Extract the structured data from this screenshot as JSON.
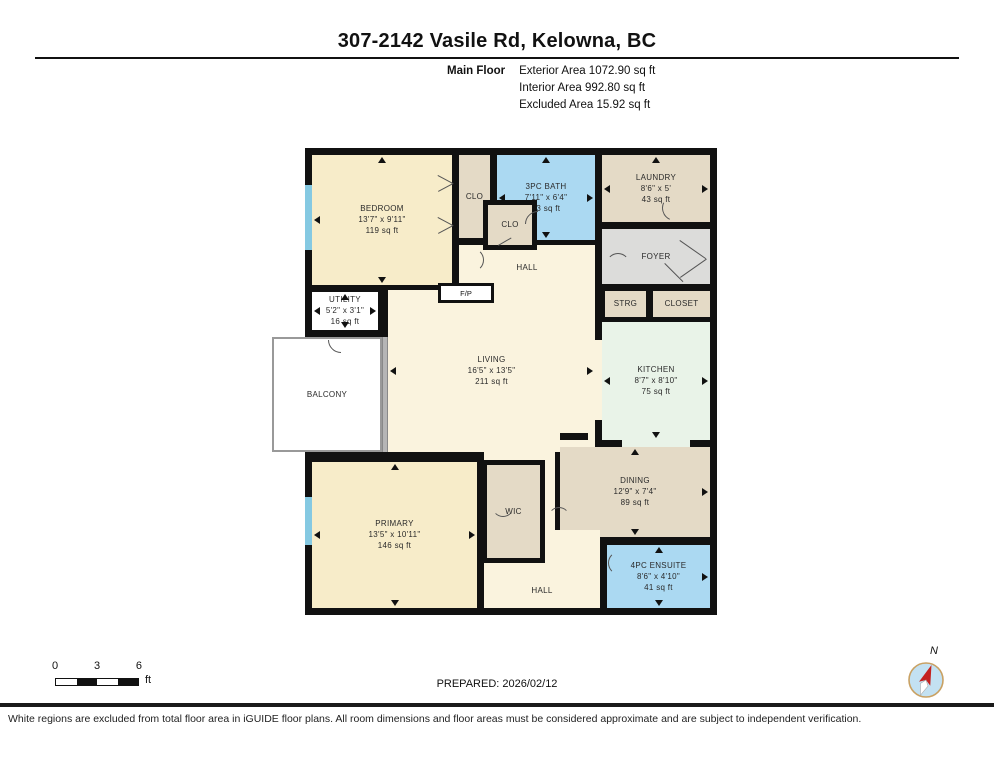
{
  "header": {
    "title": "307-2142 Vasile Rd, Kelowna, BC",
    "floor_label": "Main Floor",
    "exterior_area": "Exterior Area 1072.90 sq ft",
    "interior_area": "Interior Area 992.80 sq ft",
    "excluded_area": "Excluded Area 15.92 sq ft"
  },
  "rooms": {
    "bedroom": {
      "name": "BEDROOM",
      "dims": "13'7\" x 9'11\"",
      "area": "119 sq ft"
    },
    "bath3pc": {
      "name": "3PC BATH",
      "dims": "7'11\" x 6'4\"",
      "area": "43 sq ft"
    },
    "laundry": {
      "name": "LAUNDRY",
      "dims": "8'6\" x 5'",
      "area": "43 sq ft"
    },
    "utility": {
      "name": "UTILITY",
      "dims": "5'2\" x 3'1\"",
      "area": "16 sq ft"
    },
    "living": {
      "name": "LIVING",
      "dims": "16'5\" x 13'5\"",
      "area": "211 sq ft"
    },
    "kitchen": {
      "name": "KITCHEN",
      "dims": "8'7\" x 8'10\"",
      "area": "75 sq ft"
    },
    "dining": {
      "name": "DINING",
      "dims": "12'9\" x 7'4\"",
      "area": "89 sq ft"
    },
    "primary": {
      "name": "PRIMARY",
      "dims": "13'5\" x 10'11\"",
      "area": "146 sq ft"
    },
    "ensuite4pc": {
      "name": "4PC ENSUITE",
      "dims": "8'6\" x 4'10\"",
      "area": "41 sq ft"
    },
    "clo_a": {
      "name": "CLO"
    },
    "clo_b": {
      "name": "CLO"
    },
    "hall_upper": {
      "name": "HALL"
    },
    "hall_lower": {
      "name": "HALL"
    },
    "foyer": {
      "name": "FOYER"
    },
    "strg": {
      "name": "STRG"
    },
    "closet": {
      "name": "CLOSET"
    },
    "fp": {
      "name": "F/P"
    },
    "balcony": {
      "name": "BALCONY"
    },
    "wic": {
      "name": "WIC"
    }
  },
  "footer": {
    "scale_ticks": [
      "0",
      "3",
      "6"
    ],
    "scale_unit": "ft",
    "prepared": "PREPARED: 2026/02/12",
    "compass_north": "N",
    "disclaimer": "White regions are excluded from total floor area in iGUIDE floor plans. All room dimensions and floor areas must be considered approximate and are subject to independent verification."
  },
  "colors": {
    "wall": "#111111",
    "room_cream": "#F7ECC9",
    "room_cream_light": "#FAF3DE",
    "room_tan": "#E4DAC6",
    "room_blue": "#ABD9F2",
    "room_mint": "#E9F3E8",
    "room_gray": "#DCDCDA",
    "window_blue": "#85C9E2",
    "compass_red": "#C4211F",
    "compass_blue": "#C3E1F2",
    "compass_ring": "#C9A163"
  }
}
